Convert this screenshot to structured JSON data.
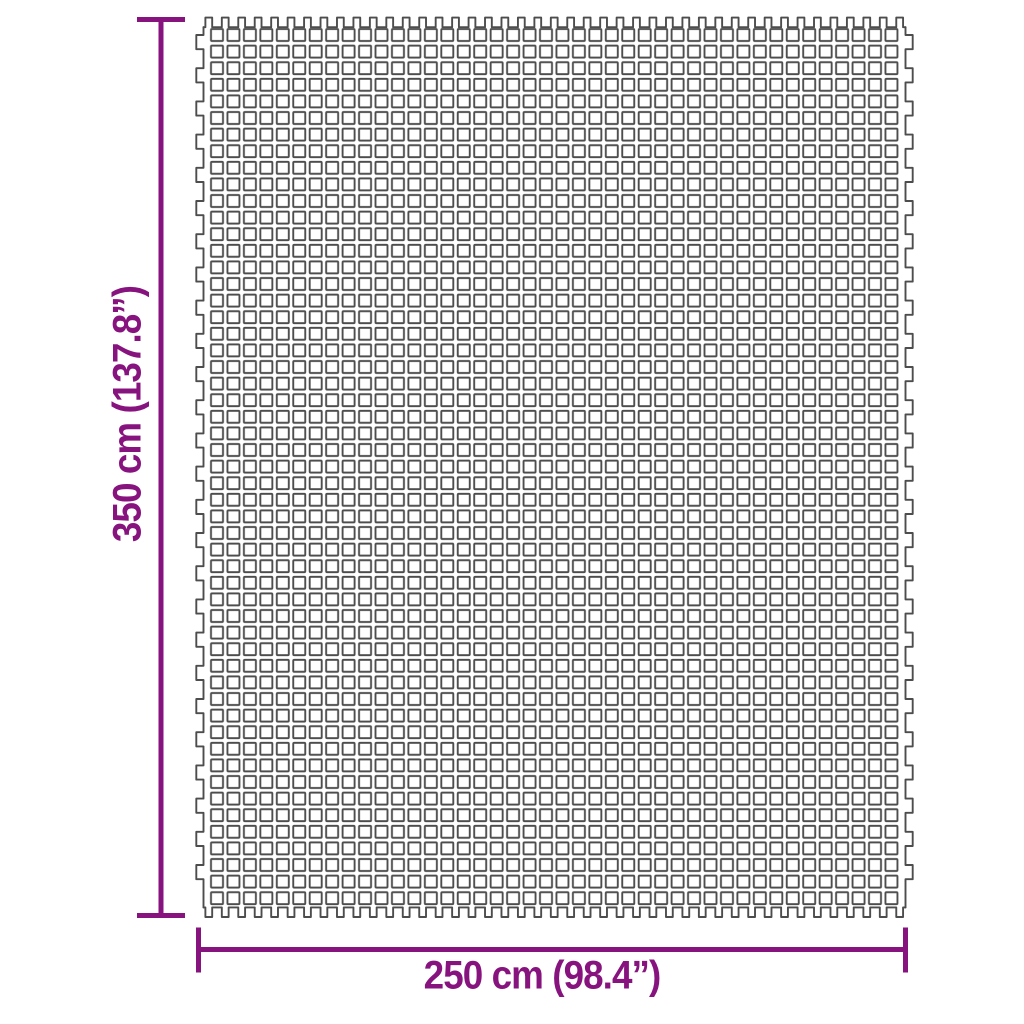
{
  "page": {
    "type": "product-dimension-diagram",
    "background": "#ffffff"
  },
  "colors": {
    "accent": "#87137e",
    "mat_stroke": "#4d4d4d"
  },
  "labels": {
    "height": "350 cm (137.8”)",
    "width": "250 cm (98.4”)"
  },
  "mat": {
    "description": "rectangular grid mat drawn as rows of small open squares with castellated fringe edges",
    "cols": 42,
    "rows": 53,
    "cell_w": 16.45,
    "cell_h": 16.6,
    "square": 12,
    "corner_radius": 1,
    "origin_x": 211,
    "origin_y": 29,
    "stroke_width": 1.9,
    "fringe": {
      "prong_w": 6.8,
      "prong_h": 9.6,
      "bump_w": 7.2,
      "bump_h": 14.2,
      "bump_start_y": 35,
      "bump_count": 26,
      "row_step": 33.2,
      "left_x": 203.5,
      "right_x": 905.5,
      "top_y": 27.2,
      "bottom_y": 907.4
    }
  },
  "dimension_lines": {
    "stroke_width": 5,
    "vertical": {
      "x": 161,
      "y1": 17,
      "y2": 918,
      "cap_x1": 137,
      "cap_x2": 185,
      "cap_top_y": 19.5,
      "cap_bottom_y": 915.5
    },
    "horizontal": {
      "y": 949.5,
      "x1": 196.5,
      "x2": 907.5,
      "cap_y1": 927.5,
      "cap_y2": 972.5,
      "cap_left_x": 198.5,
      "cap_right_x": 905.5
    }
  }
}
